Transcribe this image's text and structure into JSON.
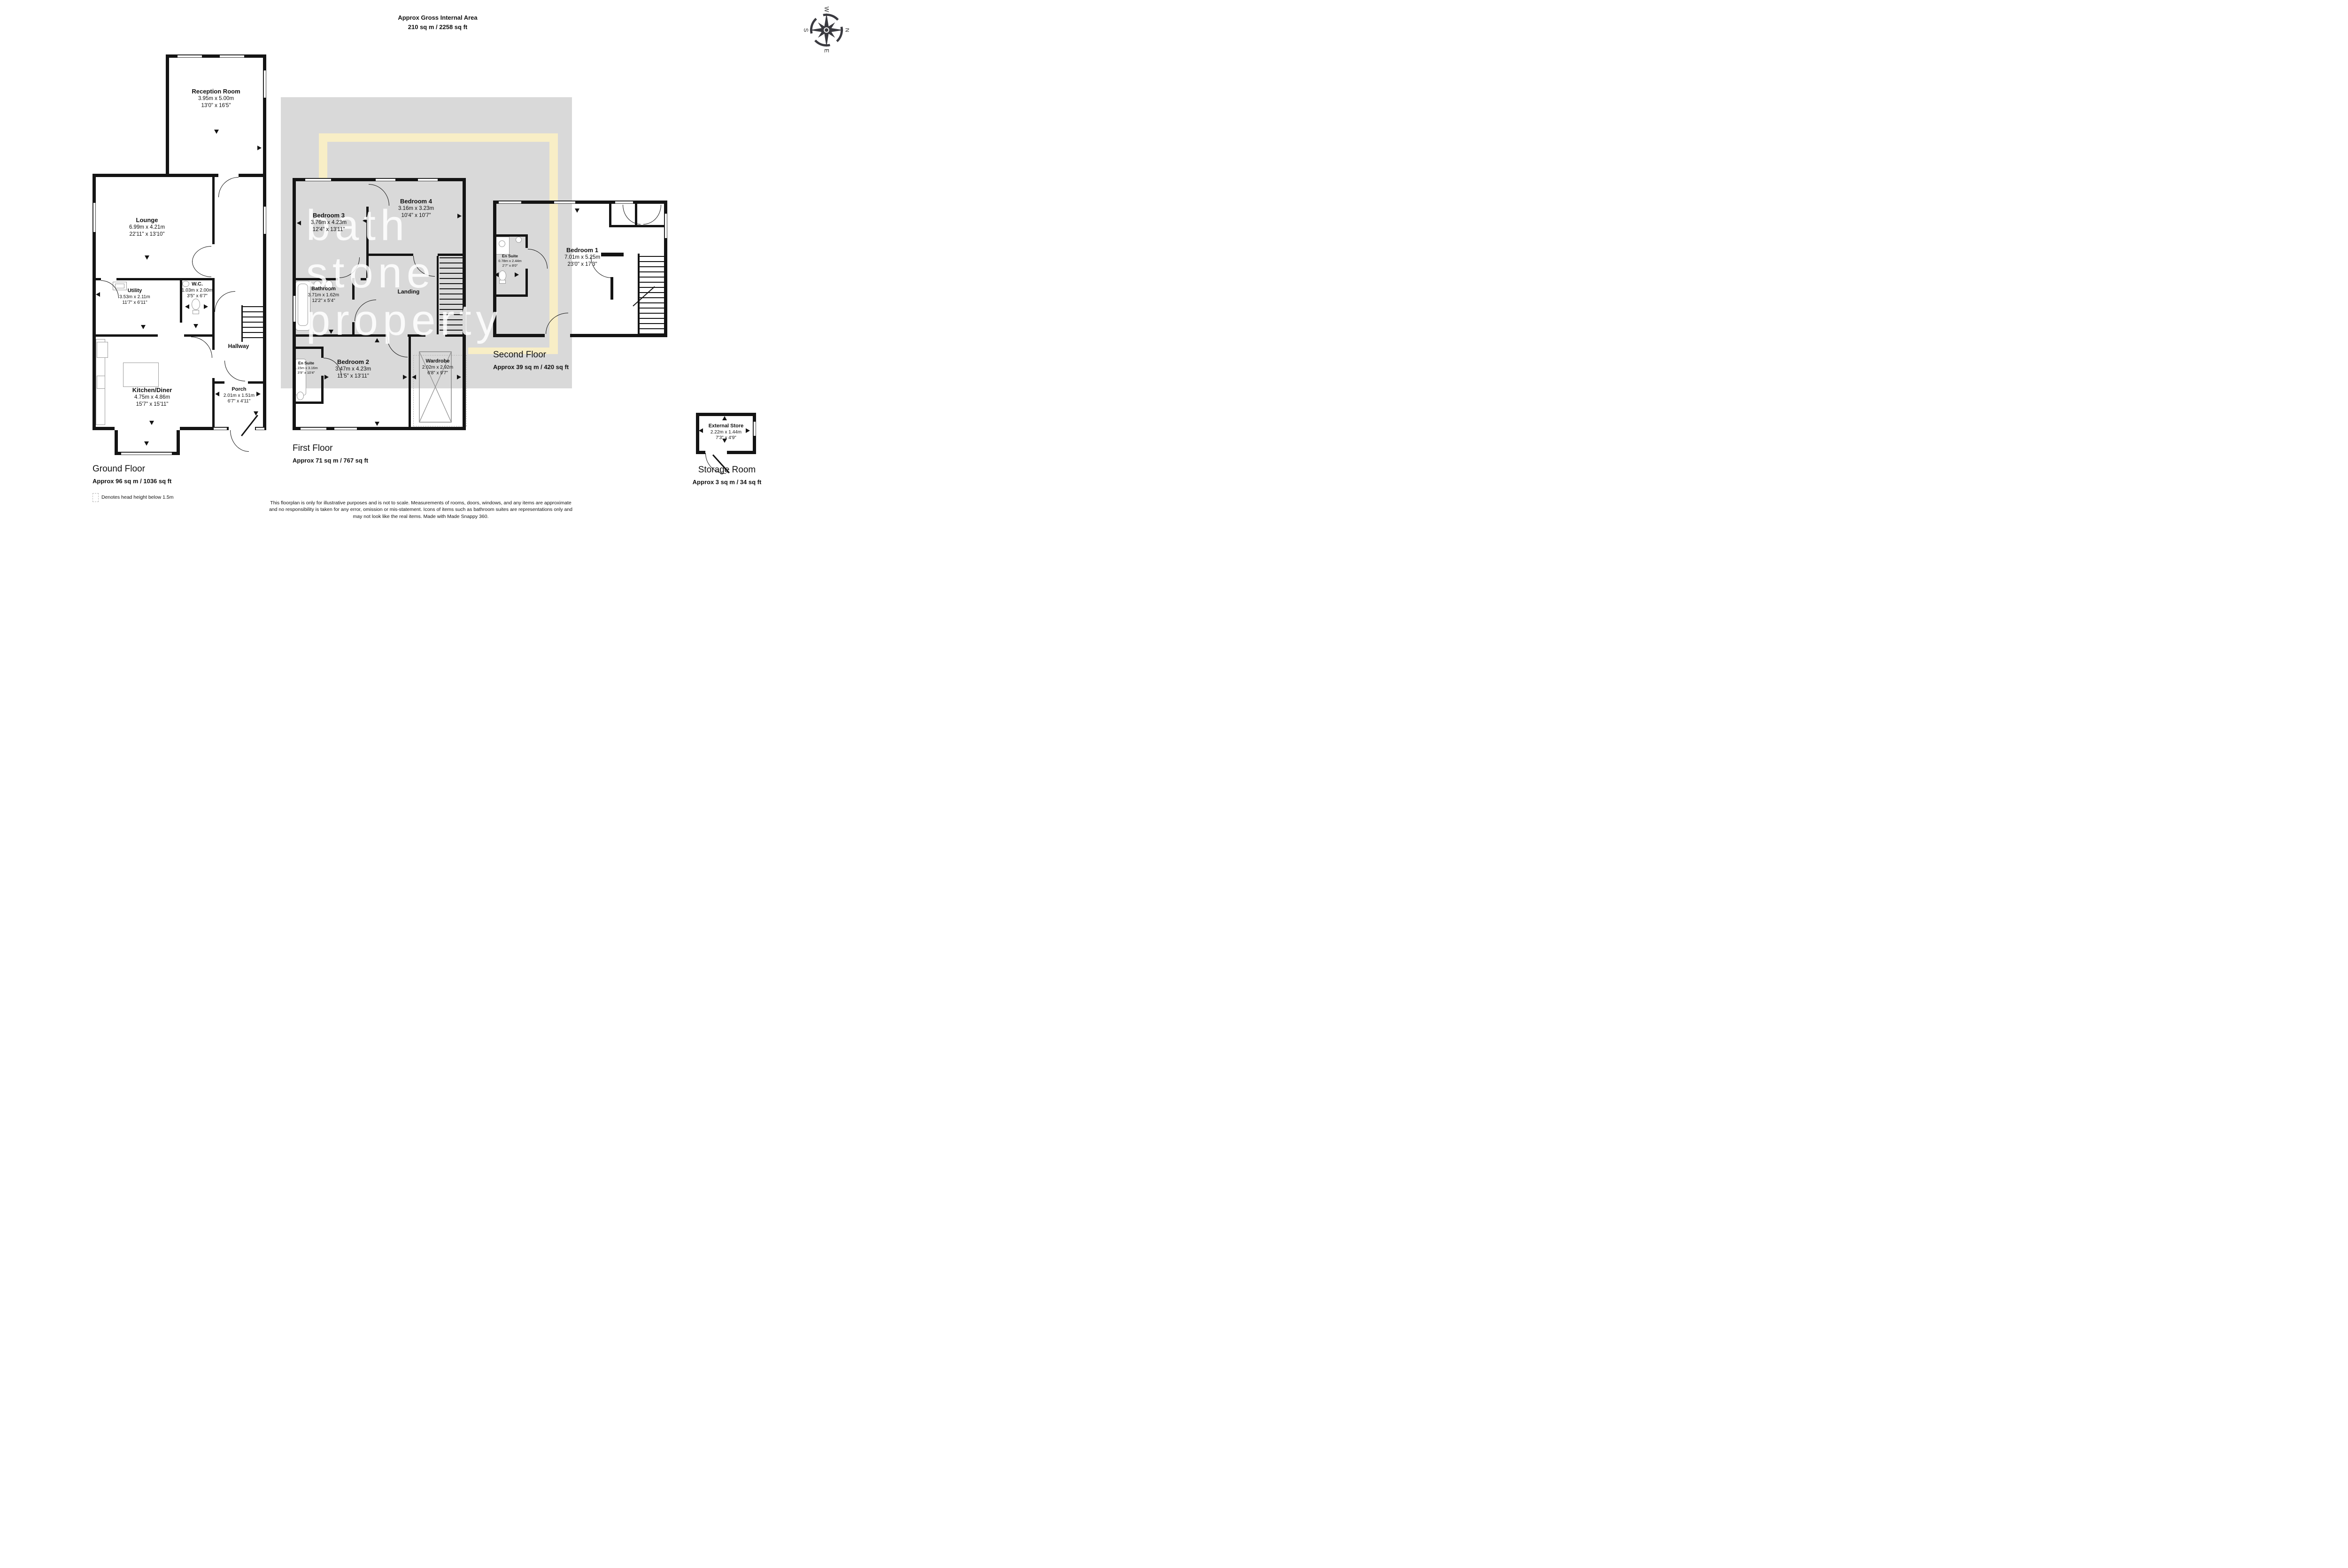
{
  "header": {
    "title": "Approx Gross Internal Area",
    "subtitle": "210 sq m / 2258 sq ft"
  },
  "compass": {
    "north": "N",
    "east": "E",
    "south": "S",
    "west": "W"
  },
  "watermark": {
    "line1": "bath",
    "line2": "stone",
    "line3": "property"
  },
  "colors": {
    "wall": "#141414",
    "watermark_panel": "#d9d9d9",
    "highlight": "#f8eec6",
    "text": "#111111"
  },
  "ground_floor": {
    "title": "Ground Floor",
    "area": "Approx 96 sq m / 1036 sq ft",
    "rooms": {
      "reception": {
        "name": "Reception Room",
        "metric": "3.95m x 5.00m",
        "imperial": "13'0\" x 16'5\""
      },
      "lounge": {
        "name": "Lounge",
        "metric": "6.99m x 4.21m",
        "imperial": "22'11\" x 13'10\""
      },
      "utility": {
        "name": "Utility",
        "metric": "3.53m x 2.11m",
        "imperial": "11'7\" x 6'11\""
      },
      "wc": {
        "name": "W.C.",
        "metric": "1.03m x 2.00m",
        "imperial": "3'5\" x 6'7\""
      },
      "hallway": {
        "name": "Hallway"
      },
      "kitchen": {
        "name": "Kitchen/Diner",
        "metric": "4.75m x 4.86m",
        "imperial": "15'7\" x 15'11\""
      },
      "porch": {
        "name": "Porch",
        "metric": "2.01m x 1.51m",
        "imperial": "6'7\" x 4'11\""
      }
    }
  },
  "first_floor": {
    "title": "First Floor",
    "area": "Approx 71 sq m / 767 sq ft",
    "rooms": {
      "bedroom3": {
        "name": "Bedroom 3",
        "metric": "3.76m x 4.23m",
        "imperial": "12'4\" x 13'11\""
      },
      "bedroom4": {
        "name": "Bedroom 4",
        "metric": "3.16m x 3.23m",
        "imperial": "10'4\" x 10'7\""
      },
      "bathroom": {
        "name": "Bathroom",
        "metric": "3.71m x 1.62m",
        "imperial": "12'2\" x 5'4\""
      },
      "landing": {
        "name": "Landing"
      },
      "bedroom2": {
        "name": "Bedroom 2",
        "metric": "3.47m x 4.23m",
        "imperial": "11'5\" x 13'11\""
      },
      "en_suite": {
        "name": "En Suite",
        "metric": "1.15m x 3.16m",
        "imperial": "3'9\" x 10'4\""
      },
      "wardrobe": {
        "name": "Wardrobe",
        "metric": "2.02m x 2.92m",
        "imperial": "6'8\" x 9'7\""
      }
    }
  },
  "second_floor": {
    "title": "Second Floor",
    "area": "Approx 39 sq m / 420 sq ft",
    "rooms": {
      "bedroom1": {
        "name": "Bedroom 1",
        "metric": "7.01m x 5.25m",
        "imperial": "23'0\" x 17'3\""
      },
      "en_suite": {
        "name": "En Suite",
        "metric": "0.78m x 2.44m",
        "imperial": "2'7\" x 8'0\""
      }
    }
  },
  "storage": {
    "title": "Storage Room",
    "area": "Approx 3 sq m / 34 sq ft",
    "rooms": {
      "external_store": {
        "name": "External Store",
        "metric": "2.22m x 1.44m",
        "imperial": "7'3\" x 4'9\""
      }
    }
  },
  "legend": {
    "head_height_note": "Denotes head height below 1.5m"
  },
  "footer": {
    "lines": [
      "This floorplan is only for illustrative purposes and is not to scale. Measurements of rooms, doors, windows, and any items are approximate",
      "and no responsibility is taken for any error, omission or mis-statement. Icons of items such as bathroom suites are representations only and",
      "may not look like the real items. Made with Made Snappy 360."
    ]
  }
}
